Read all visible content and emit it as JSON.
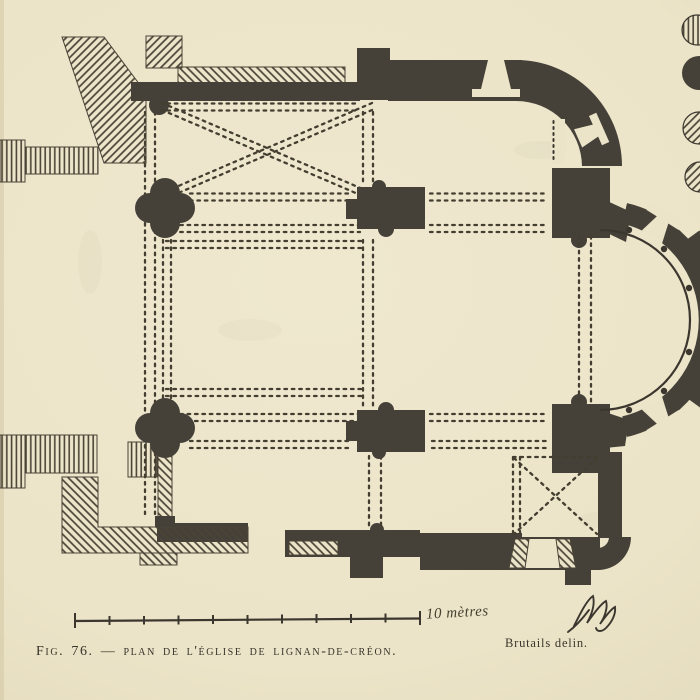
{
  "figure": {
    "caption": "Fig. 76. — plan de l'église de lignan-de-créon.",
    "figure_number": "Fig. 76.",
    "subject": "Plan de l'église de Lignan-de-Créon",
    "credit": "Brutails delin."
  },
  "scale_bar": {
    "label": "10 mètres",
    "divisions": 10
  },
  "legend": {
    "symbols": [
      "vertical-hatch-circle",
      "solid-black-circle",
      "diagonal-hatch-circle",
      "diagonal-hatch-circle"
    ]
  },
  "colors": {
    "paper": "#ece4c8",
    "ink": "#3b362e",
    "wall_fill": "#454139",
    "hatch": "#4a4336"
  }
}
